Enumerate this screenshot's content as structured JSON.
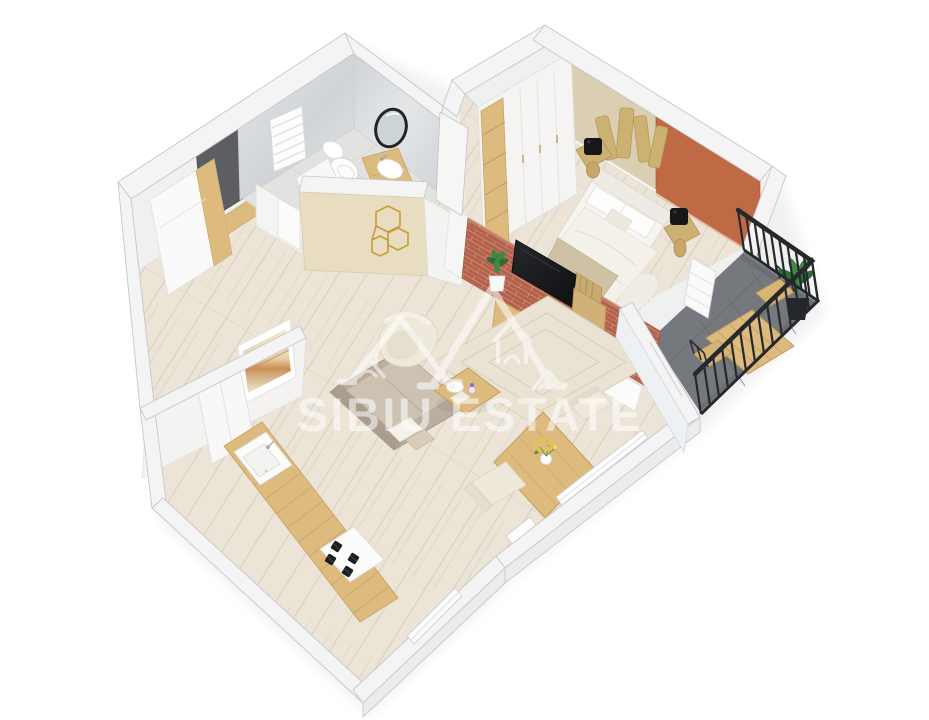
{
  "image": {
    "type": "3d-floor-plan-render",
    "width": 929,
    "height": 720,
    "background": "#ffffff"
  },
  "watermark": {
    "text": "SIBIU ESTATE",
    "color": "#ffffff",
    "opacity": 0.55,
    "logo": "overlapping-house-roof-outlines"
  },
  "palette": {
    "wall_top": "#f4f4f5",
    "wall_stroke": "#c7c7cc",
    "wall_face": "#f1f0ee",
    "wall_outer": "#ececee",
    "wood_floor": "#ebe4d7",
    "wood_floor_line": "#d8cebd",
    "marble_hi": "#e4e6e8",
    "marble_lo": "#d0d4d7",
    "beige_wall": "#dbcfb3",
    "beige_wall_lit": "#e9ddc1",
    "terracotta": "#c06a45",
    "brick": "#b4604a",
    "brick_mortar": "#c98d75",
    "wood_furn": "#ddbb7e",
    "wood_dark": "#c29c5c",
    "sofa": "#bbaea1",
    "sofa_dark": "#aa9d8f",
    "sofa_light": "#cdc1b2",
    "cream": "#efe9db",
    "rug": "#eae2d3",
    "rug_line": "#d9cebb",
    "balcony_floor": "#75797e",
    "balcony_tile": "#63676b",
    "railing": "#26282b",
    "plant": "#3f8745",
    "plant_dark": "#2e6b35",
    "gold": "#c79c38",
    "gold_wood": "#cdb173",
    "tv": "#191a1c",
    "door_gray": "#5c5e61",
    "white": "#fafafa",
    "flower": "#e9c53a",
    "blanket": "#cfc2a4"
  },
  "balcony_railing": {
    "points": [
      [
        744,
        250
      ],
      [
        818,
        301
      ],
      [
        701,
        414
      ]
    ],
    "top_offset": [
      -6,
      -40
    ],
    "bars_per_segment": [
      9,
      13
    ],
    "color": "#26282b"
  },
  "rooms": {
    "entry_hall": {
      "items": [
        "entry-door",
        "hall-closet",
        "door-threshold"
      ]
    },
    "bathroom": {
      "items": [
        "towel-radiator",
        "toilet",
        "vanity-sink",
        "round-mirror",
        "washer-shower-unit",
        "gold-geometric-wall-art",
        "marble-walls"
      ]
    },
    "bedroom": {
      "items": [
        "wardrobe",
        "double-bed",
        "pillows",
        "blanket",
        "nightstand-left",
        "nightstand-right",
        "table-lamp-left",
        "table-lamp-right",
        "wood-wall-art",
        "terracotta-accent-wall",
        "fluffy-rug"
      ]
    },
    "living_room": {
      "items": [
        "sofa",
        "armchair",
        "coffee-table",
        "area-rug",
        "tv",
        "brick-media-wall",
        "media-cabinet",
        "shelf-unit",
        "potted-plant",
        "white-bench"
      ]
    },
    "dining_area": {
      "items": [
        "dining-table",
        "dining-chair-front",
        "dining-chair-back",
        "flower-vase",
        "window"
      ]
    },
    "kitchen": {
      "items": [
        "countertop",
        "kitchen-sink",
        "gas-hob",
        "fridge-cabinet",
        "framed-artwork",
        "window"
      ]
    },
    "balcony": {
      "items": [
        "black-metal-railing",
        "outdoor-table",
        "outdoor-chair-upper",
        "outdoor-chair-lower",
        "potted-plant",
        "ac-unit",
        "gray-tile-floor"
      ]
    }
  }
}
